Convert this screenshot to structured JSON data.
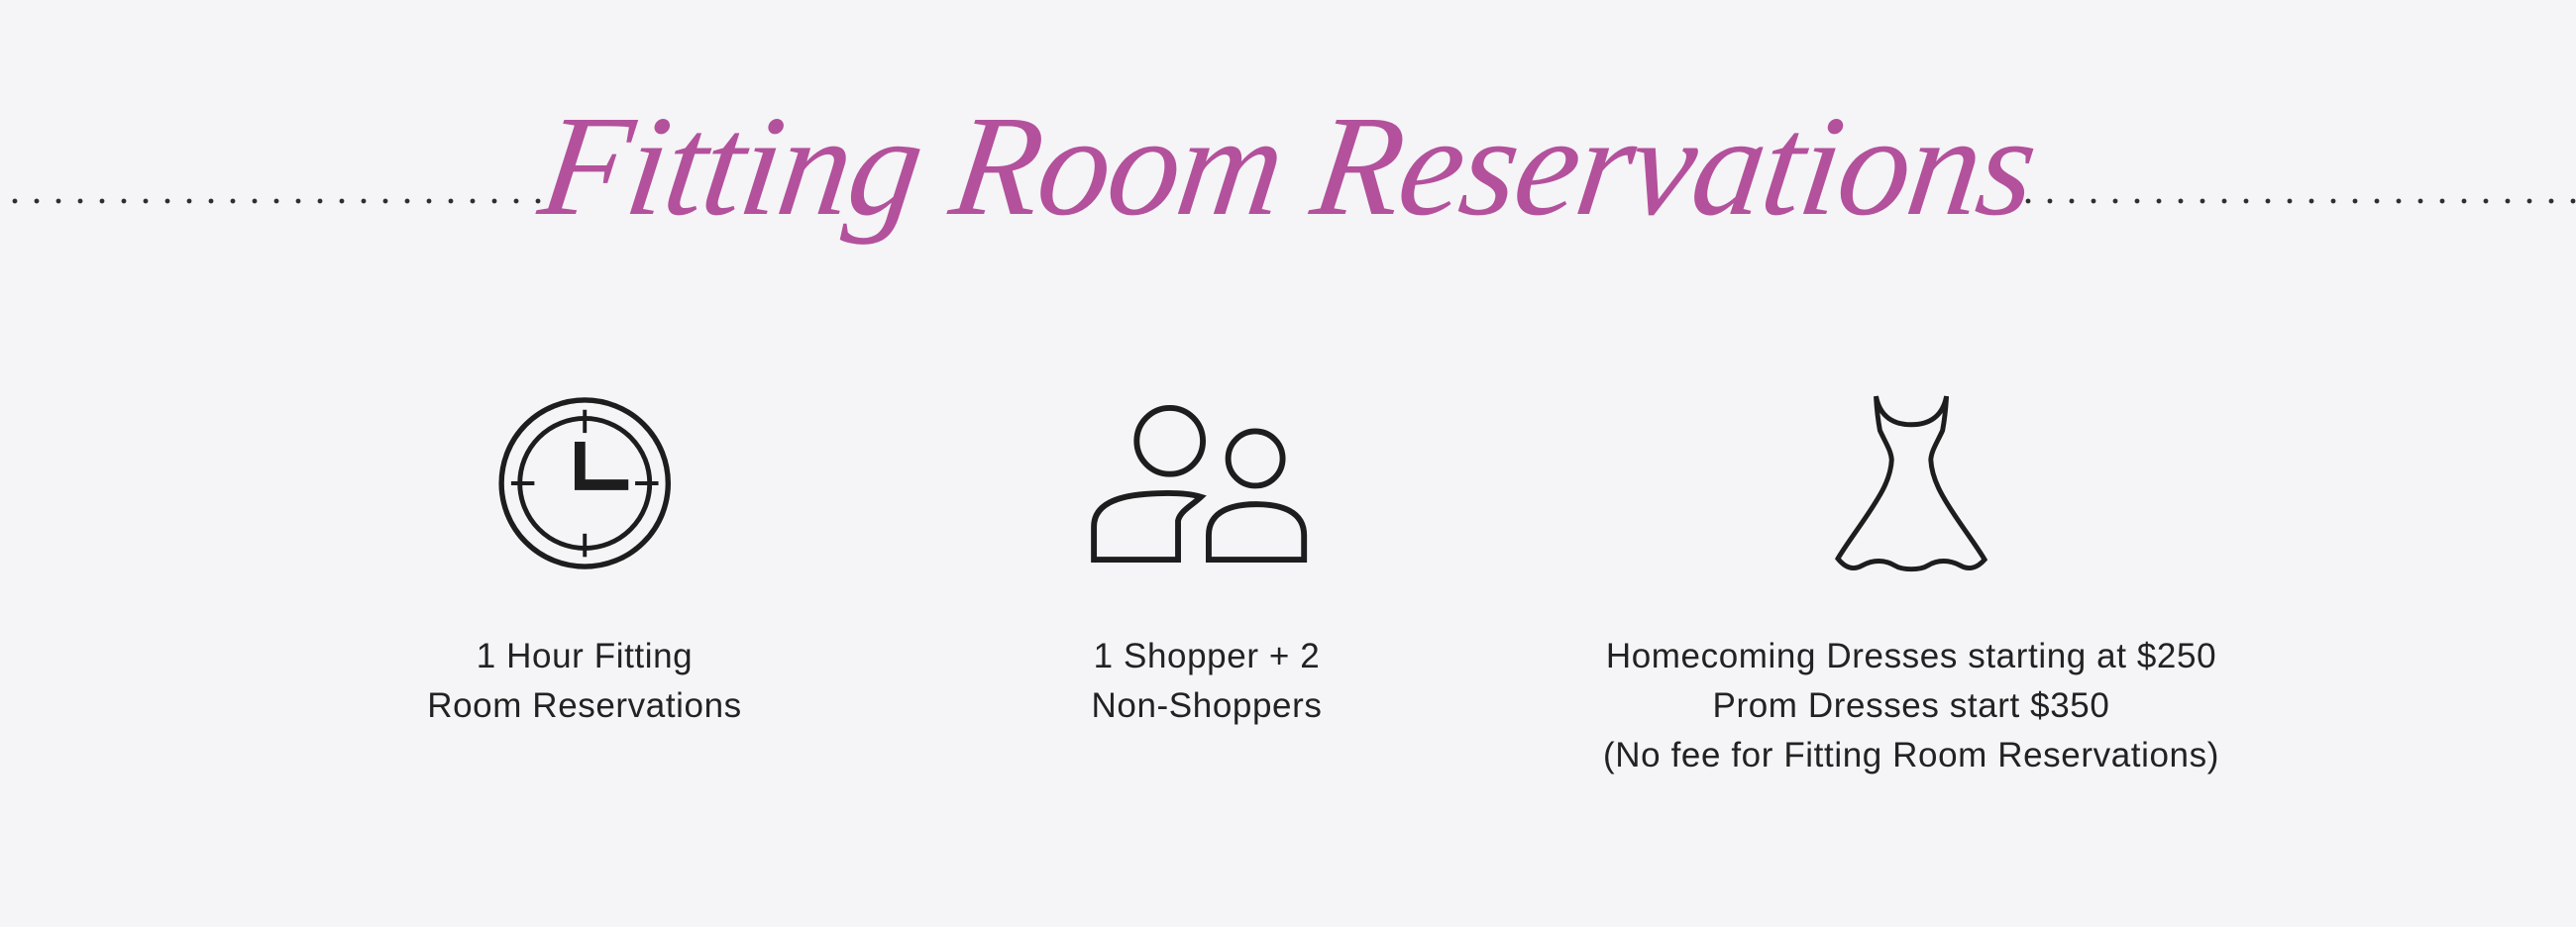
{
  "background_color": "#f5f4f6",
  "header": {
    "title": "Fitting Room Reservations",
    "title_color": "#b3519c",
    "divider_style": "dotted"
  },
  "features": [
    {
      "icon": "clock-icon",
      "lines": [
        "1 Hour Fitting",
        "Room Reservations"
      ]
    },
    {
      "icon": "people-icon",
      "lines": [
        "1 Shopper + 2",
        "Non-Shoppers"
      ]
    },
    {
      "icon": "dress-icon",
      "lines": [
        "Homecoming Dresses starting at $250",
        "Prom Dresses start $350",
        "(No fee for Fitting Room Reservations)"
      ]
    }
  ],
  "colors": {
    "text": "#222222",
    "icon_stroke": "#1d1d1d",
    "dot": "#2e2e2e"
  }
}
